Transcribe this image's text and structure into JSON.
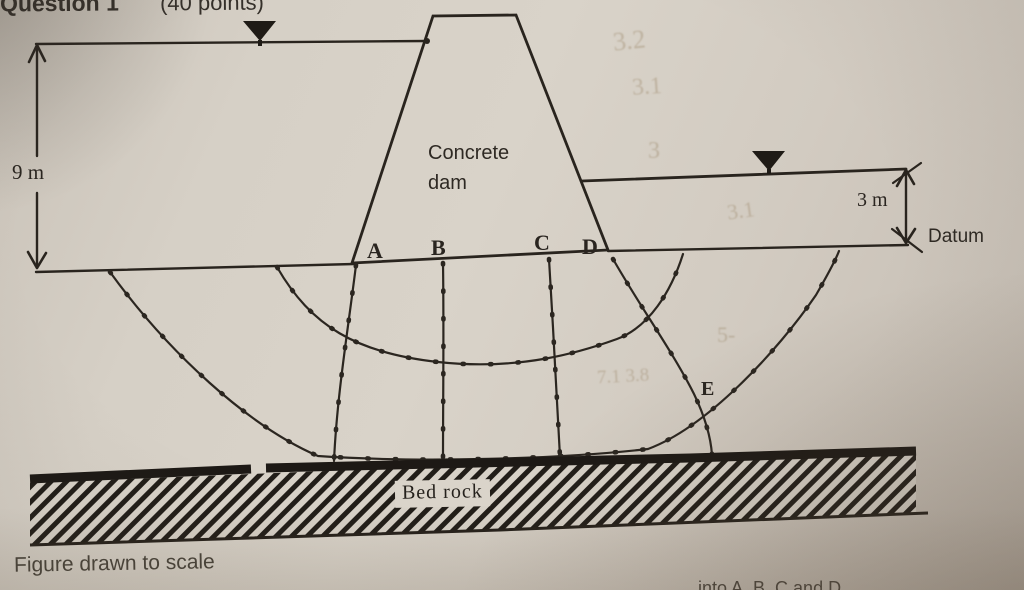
{
  "header": {
    "question": "Question 1",
    "points": "(40 points)"
  },
  "diagram": {
    "dam_label": "Concrete dam",
    "upstream_depth": "9 m",
    "downstream_depth": "3 m",
    "datum": "Datum",
    "points": {
      "A": "A",
      "B": "B",
      "C": "C",
      "D": "D",
      "E": "E"
    },
    "bedrock": "Bed rock",
    "caption": "Figure drawn to scale",
    "cutoff_text": "into A, B, C and D"
  },
  "ghost_marks": [
    {
      "text": "3.2"
    },
    {
      "text": "3.1"
    },
    {
      "text": "3"
    },
    {
      "text": "3.1"
    },
    {
      "text": "5-"
    },
    {
      "text": "7.1 3.8"
    }
  ],
  "colors": {
    "paper": "#d4cdc3",
    "ink": "#272219",
    "caption_ink": "#474239"
  }
}
